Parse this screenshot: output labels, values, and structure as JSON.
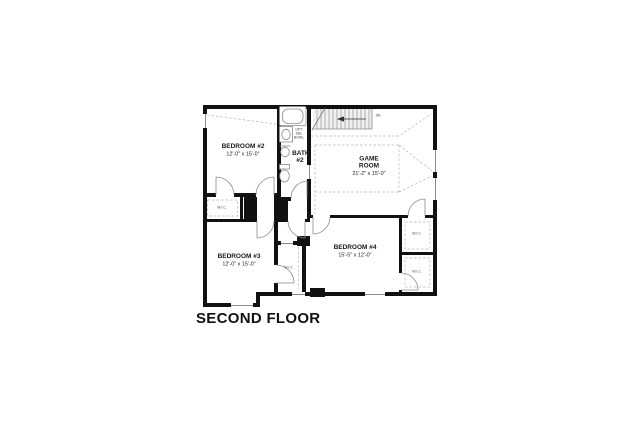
{
  "floor_plan": {
    "title": "SECOND FLOOR",
    "rooms": {
      "bedroom2": {
        "name": "BEDROOM #2",
        "dims": "12'-0\" x 15'-0\""
      },
      "bedroom3": {
        "name": "BEDROOM #3",
        "dims": "12'-0\" x 15'-0\""
      },
      "bedroom4": {
        "name": "BEDROOM #4",
        "dims": "15'-5\" x 12'-0\""
      },
      "game_room": {
        "name": "GAME ROOM",
        "dims": "21'-2\" x 15'-0\""
      },
      "bath2": {
        "name": "BATH #2"
      }
    },
    "closet_label": "W.I.C.",
    "stairs_label": "DN",
    "bath_note": "OPT DBL BOWL"
  },
  "colors": {
    "wall": "#111111",
    "fixture_line": "#8a8a8a",
    "dashed_line": "#b5b5b5",
    "background": "#ffffff"
  }
}
